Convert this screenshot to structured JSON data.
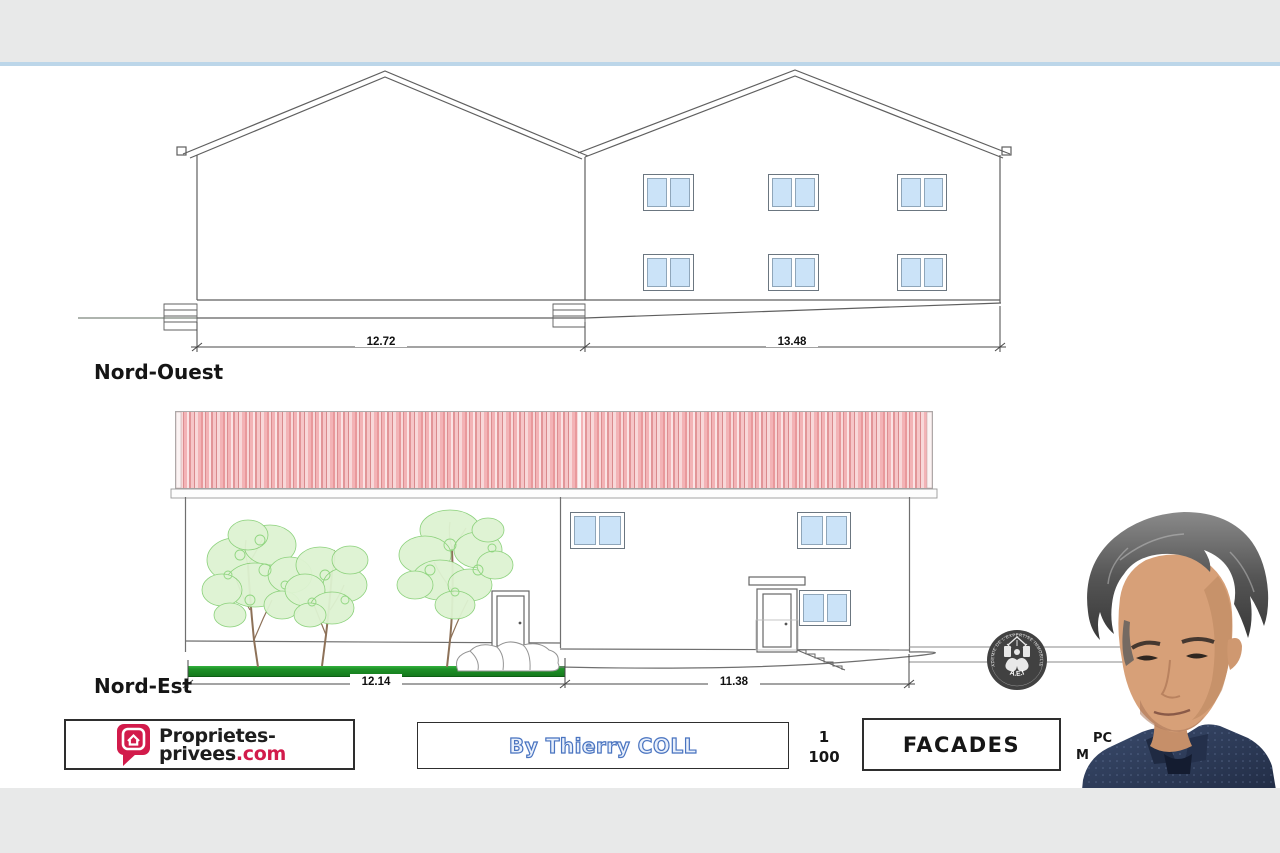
{
  "drawing": {
    "nord_ouest": {
      "label": "Nord-Ouest",
      "dim_left": "12.72",
      "dim_right": "13.48"
    },
    "nord_est": {
      "label": "Nord-Est",
      "dim_left": "12.14",
      "dim_right": "11.38"
    }
  },
  "title_block": {
    "brand": {
      "line1": "Proprietes-",
      "line2_name": "privees",
      "line2_tld": ".com"
    },
    "author": "By Thierry COLL",
    "scale": {
      "numerator": "1",
      "denominator": "100"
    },
    "drawing_title": "FACADES",
    "doc_ref": {
      "line1": "PC",
      "line2": "M"
    }
  },
  "stamp": {
    "ring_text": "ACADEMIE DE L'EXPERTISE IMMOBILIERE",
    "acronym": "A.E.I"
  },
  "colors": {
    "accent_red": "#d21b4b",
    "roof_red": "#f3b3b6",
    "window_blue": "#cbe3f8",
    "hedge_green": "#1f9128",
    "author_blue": "#4a74c0",
    "bar_gray": "#e8e9e9",
    "separator_blue": "#bcd6e9"
  }
}
